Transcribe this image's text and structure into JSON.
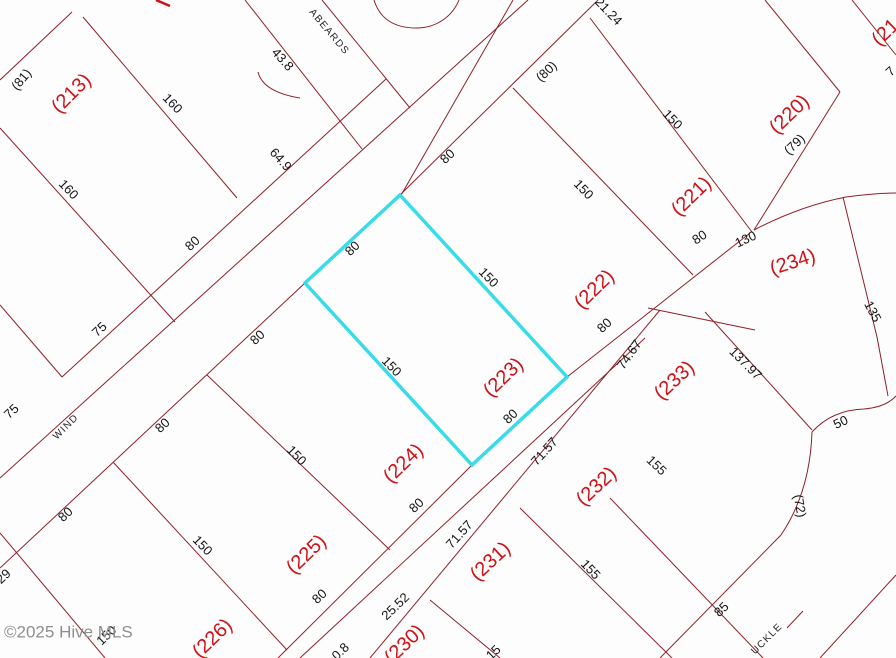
{
  "map": {
    "watermark": "©2025 Hive MLS",
    "highlight_color": "#38dbe8",
    "boundary_color": "#8e2028",
    "parcel_label_color": "#cf1217",
    "highlight": {
      "label": "(223)",
      "points": "400,195 567,377 472,465 305,283"
    },
    "boundaries": [
      [
        72,
        12,
        0,
        80
      ],
      [
        83,
        17,
        237,
        198
      ],
      [
        0,
        128,
        175,
        322
      ],
      [
        0,
        305,
        62,
        377
      ],
      [
        62,
        377,
        386,
        79
      ],
      [
        0,
        478,
        528,
        0
      ],
      [
        0,
        568,
        305,
        283
      ],
      [
        400,
        195,
        598,
        0
      ],
      [
        322,
        0,
        410,
        108
      ],
      [
        245,
        0,
        362,
        149
      ],
      [
        513,
        0,
        400,
        197
      ],
      [
        207,
        375,
        390,
        550
      ],
      [
        113,
        462,
        287,
        650
      ],
      [
        0,
        533,
        105,
        658
      ],
      [
        278,
        658,
        472,
        465
      ],
      [
        567,
        377,
        750,
        233
      ],
      [
        300,
        658,
        645,
        338
      ],
      [
        370,
        658,
        660,
        310
      ],
      [
        430,
        600,
        500,
        658
      ],
      [
        520,
        508,
        672,
        658
      ],
      [
        610,
        498,
        763,
        658
      ],
      [
        705,
        312,
        812,
        430
      ],
      [
        513,
        88,
        693,
        275
      ],
      [
        590,
        18,
        752,
        232
      ],
      [
        765,
        0,
        840,
        92
      ],
      [
        852,
        0,
        896,
        55
      ],
      [
        840,
        92,
        754,
        230
      ],
      [
        843,
        197,
        877,
        337
      ],
      [
        877,
        337,
        888,
        396
      ],
      [
        648,
        308,
        755,
        330
      ],
      [
        820,
        658,
        896,
        575
      ],
      [
        781,
        535,
        660,
        658
      ],
      [
        787,
        628,
        803,
        611
      ]
    ],
    "curves": [
      {
        "d": "M374,0 C380,20 396,28 416,28 C438,28 453,15 459,0",
        "cls": "bline"
      },
      {
        "d": "M754,230 Q800,206 846,197 Q875,193 896,193",
        "cls": "bline"
      },
      {
        "d": "M812,432 Q832,410 864,409 Q886,407 896,396",
        "cls": "bline"
      },
      {
        "d": "M812,432 Q810,492 781,535",
        "cls": "bline"
      },
      {
        "d": "M258,72 Q263,92 300,98",
        "cls": "bline"
      },
      {
        "d": "M156,0 L170,6",
        "cls": "frag"
      }
    ],
    "labels": [
      {
        "t": "(81)",
        "x": 22,
        "y": 80,
        "r": -50,
        "cls": "dim"
      },
      {
        "t": "160",
        "x": 172,
        "y": 104,
        "r": 46,
        "cls": "dim"
      },
      {
        "t": "(213)",
        "x": 72,
        "y": 94,
        "r": -45,
        "cls": "parcel"
      },
      {
        "t": "160",
        "x": 68,
        "y": 190,
        "r": 46,
        "cls": "dim"
      },
      {
        "t": "43.8",
        "x": 282,
        "y": 60,
        "r": 48,
        "cls": "dim"
      },
      {
        "t": "64.9",
        "x": 280,
        "y": 160,
        "r": 48,
        "cls": "dim"
      },
      {
        "t": "ABEARDS",
        "x": 329,
        "y": 32,
        "r": 50,
        "cls": "street"
      },
      {
        "t": "80",
        "x": 193,
        "y": 244,
        "r": -43,
        "cls": "dim"
      },
      {
        "t": "80",
        "x": 258,
        "y": 338,
        "r": -43,
        "cls": "dim"
      },
      {
        "t": "75",
        "x": 100,
        "y": 330,
        "r": -43,
        "cls": "dim"
      },
      {
        "t": "75",
        "x": 12,
        "y": 412,
        "r": -43,
        "cls": "dim"
      },
      {
        "t": "WIND",
        "x": 66,
        "y": 427,
        "r": -45,
        "cls": "street"
      },
      {
        "t": "80",
        "x": 163,
        "y": 426,
        "r": -43,
        "cls": "dim"
      },
      {
        "t": "80",
        "x": 66,
        "y": 515,
        "r": -43,
        "cls": "dim"
      },
      {
        "t": "29",
        "x": 4,
        "y": 577,
        "r": -43,
        "cls": "dim"
      },
      {
        "t": "150",
        "x": 202,
        "y": 546,
        "r": 46,
        "cls": "dim"
      },
      {
        "t": "(225)",
        "x": 307,
        "y": 555,
        "r": -44,
        "cls": "parcel"
      },
      {
        "t": "(226)",
        "x": 213,
        "y": 639,
        "r": -44,
        "cls": "parcel"
      },
      {
        "t": "150",
        "x": 296,
        "y": 456,
        "r": 46,
        "cls": "dim"
      },
      {
        "t": "(224)",
        "x": 404,
        "y": 464,
        "r": -44,
        "cls": "parcel"
      },
      {
        "t": "80",
        "x": 417,
        "y": 506,
        "r": -43,
        "cls": "dim"
      },
      {
        "t": "80",
        "x": 320,
        "y": 597,
        "r": -43,
        "cls": "dim"
      },
      {
        "t": "25.52",
        "x": 396,
        "y": 607,
        "r": -44,
        "cls": "dim"
      },
      {
        "t": "(230)",
        "x": 405,
        "y": 645,
        "r": -44,
        "cls": "parcel"
      },
      {
        "t": "0.8",
        "x": 341,
        "y": 652,
        "r": -44,
        "cls": "dim"
      },
      {
        "t": "15",
        "x": 494,
        "y": 653,
        "r": -44,
        "cls": "dim"
      },
      {
        "t": "(231)",
        "x": 491,
        "y": 562,
        "r": -43,
        "cls": "parcel"
      },
      {
        "t": "71.57",
        "x": 460,
        "y": 535,
        "r": -48,
        "cls": "dim"
      },
      {
        "t": "71.57",
        "x": 545,
        "y": 452,
        "r": -48,
        "cls": "dim"
      },
      {
        "t": "155",
        "x": 590,
        "y": 570,
        "r": 46,
        "cls": "dim"
      },
      {
        "t": "(232)",
        "x": 597,
        "y": 487,
        "r": -43,
        "cls": "parcel"
      },
      {
        "t": "155",
        "x": 656,
        "y": 466,
        "r": 44,
        "cls": "dim"
      },
      {
        "t": "85",
        "x": 722,
        "y": 610,
        "r": -44,
        "cls": "dim"
      },
      {
        "t": "UCKLE",
        "x": 767,
        "y": 639,
        "r": -45,
        "cls": "street"
      },
      {
        "t": "(72)",
        "x": 799,
        "y": 506,
        "r": 80,
        "cls": "dim"
      },
      {
        "t": "50",
        "x": 841,
        "y": 423,
        "r": -25,
        "cls": "dim"
      },
      {
        "t": "137.97",
        "x": 745,
        "y": 364,
        "r": 45,
        "cls": "dim"
      },
      {
        "t": "(233)",
        "x": 675,
        "y": 381,
        "r": -43,
        "cls": "parcel"
      },
      {
        "t": "74.67",
        "x": 630,
        "y": 355,
        "r": -55,
        "cls": "dim"
      },
      {
        "t": "80",
        "x": 605,
        "y": 326,
        "r": -43,
        "cls": "dim"
      },
      {
        "t": "(222)",
        "x": 595,
        "y": 290,
        "r": -44,
        "cls": "parcel"
      },
      {
        "t": "80",
        "x": 353,
        "y": 249,
        "r": -44,
        "cls": "dim"
      },
      {
        "t": "150",
        "x": 488,
        "y": 278,
        "r": 46,
        "cls": "dim"
      },
      {
        "t": "150",
        "x": 391,
        "y": 367,
        "r": 46,
        "cls": "dim"
      },
      {
        "t": "80",
        "x": 511,
        "y": 417,
        "r": -44,
        "cls": "dim"
      },
      {
        "t": "(223)",
        "x": 504,
        "y": 378,
        "r": -44,
        "cls": "parcel"
      },
      {
        "t": "80",
        "x": 448,
        "y": 157,
        "r": -43,
        "cls": "dim"
      },
      {
        "t": "(80)",
        "x": 547,
        "y": 72,
        "r": -43,
        "cls": "dim"
      },
      {
        "t": "21.24",
        "x": 608,
        "y": 12,
        "r": 46,
        "cls": "dim"
      },
      {
        "t": "150",
        "x": 583,
        "y": 190,
        "r": 46,
        "cls": "dim"
      },
      {
        "t": "150",
        "x": 672,
        "y": 120,
        "r": 46,
        "cls": "dim"
      },
      {
        "t": "(221)",
        "x": 692,
        "y": 197,
        "r": -44,
        "cls": "parcel"
      },
      {
        "t": "(220)",
        "x": 790,
        "y": 115,
        "r": -44,
        "cls": "parcel"
      },
      {
        "t": "(79)",
        "x": 795,
        "y": 145,
        "r": -44,
        "cls": "dim"
      },
      {
        "t": "(21",
        "x": 886,
        "y": 33,
        "r": -44,
        "cls": "parcel"
      },
      {
        "t": "7",
        "x": 891,
        "y": 72,
        "r": -43,
        "cls": "dim"
      },
      {
        "t": "80",
        "x": 700,
        "y": 238,
        "r": -33,
        "cls": "dim"
      },
      {
        "t": "130",
        "x": 746,
        "y": 240,
        "r": -25,
        "cls": "dim"
      },
      {
        "t": "(234)",
        "x": 793,
        "y": 263,
        "r": -18,
        "cls": "parcel"
      },
      {
        "t": "135",
        "x": 872,
        "y": 312,
        "r": 62,
        "cls": "dim"
      },
      {
        "t": "150",
        "x": 107,
        "y": 636,
        "r": -44,
        "cls": "dim"
      },
      {
        "t": "©2025 Hive MLS",
        "x": 4,
        "y": 633,
        "r": 0,
        "cls": "wm",
        "name": "watermark"
      }
    ]
  }
}
